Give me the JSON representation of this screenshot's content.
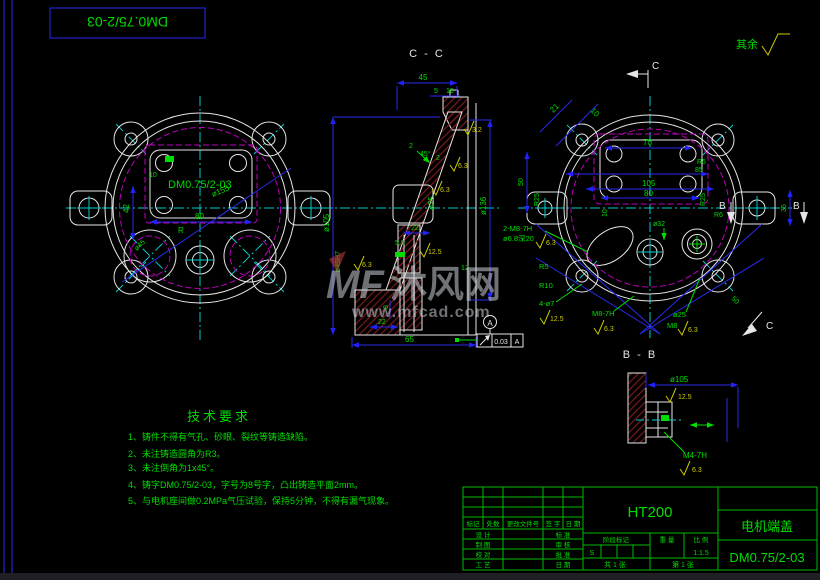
{
  "frame": {
    "flipped_title": "DM0.75/2-03"
  },
  "rest_note": {
    "label": "其余"
  },
  "left_view": {
    "part_label": "DM0.75/2-03",
    "dia_155": "ø155",
    "width_80": "80",
    "height_42": "42",
    "radius_r": "R",
    "dia_45": "ø45",
    "dim_10": "10"
  },
  "section_cc": {
    "title": "C - C",
    "depth_45": "45",
    "step_5": "5",
    "step_10": "10",
    "chamfer_left": "2",
    "chamfer_angle": "45°",
    "chamfer_right": "2",
    "dia_105": "ø105",
    "dia_136": "ø136",
    "dia_25": "ø25",
    "bore": "ø45H7",
    "len_22_upper": "22",
    "len_5_5": "5.5",
    "len_8": "8",
    "len_22_lower": "22",
    "len_65": "65",
    "len_12": "12",
    "finish_3_2": "3.2",
    "finish_6_3_a": "6.3",
    "finish_6_3_b": "6.3",
    "finish_6_3_c": "6.3",
    "finish_12_5": "12.5",
    "datum_label": "A",
    "tolerance_value": "0.03",
    "tolerance_datum": "A"
  },
  "right_view": {
    "cut_label_c_top": "C",
    "cut_label_c_bottom": "C",
    "cut_label_b_left": "B",
    "cut_label_b_right": "B",
    "dim_21": "21",
    "dim_10_diag": "10",
    "dim_70": "70",
    "dim_r5_top": "R5",
    "dim_85": "85",
    "dim_105": "105",
    "dim_80": "80",
    "dim_r25_left": "R25",
    "dim_r25_right": "R25",
    "dim_50_left": "50",
    "dim_35": "35",
    "dim_10_small": "10",
    "dia_32": "ø32",
    "dim_r6": "R6",
    "dim_50_diag": "50",
    "thread_note": "2-M8-7H",
    "drill_note": "ø6.8深20",
    "finish_6_3_a": "6.3",
    "r5_note": "R5",
    "r10_note": "R10",
    "holes_note": "4-ø7",
    "finish_12_5": "12.5",
    "m8_note": "M8-7H",
    "finish_6_3_b": "6.3",
    "dia_25": "ø25",
    "m8_small": "M8",
    "finish_6_3_c": "6.3"
  },
  "section_bb": {
    "title": "B - B",
    "dia_105": "ø105",
    "finish_12_5": "12.5",
    "thread_m4": "M4-7H",
    "finish_6_3": "6.3"
  },
  "tech_req": {
    "title": "技术要求",
    "items": [
      "1、铸件不得有气孔、砂眼、裂纹等铸造缺陷。",
      "2、未注铸造圆角为R3。",
      "3、未注倒角为1x45°。",
      "4、铸字DM0.75/2-03，字号为8号字，凸出铸造平面2mm。",
      "5、与电机座间做0.2MPa气压试验，保持5分钟，不得有漏气现象。"
    ]
  },
  "title_block": {
    "material": "HT200",
    "part_name": "电机端盖",
    "drawing_no": "DM0.75/2-03",
    "rev_headers": [
      "标记",
      "处数",
      "更改文件号",
      "签 字",
      "日 期"
    ],
    "roles_left": [
      "设 计",
      "制 图",
      "校 对",
      "工 艺"
    ],
    "roles_right": [
      "标 准",
      "审 核",
      "批 准",
      "日 期"
    ],
    "stage_header": "阶段标记",
    "weight_header": "重 量",
    "scale_header": "比 例",
    "stage_value": "S",
    "scale_value": "1:1.5",
    "sheet_total": "共 1 张",
    "sheet_index": "第 1 张"
  },
  "watermark": {
    "logo": "MF",
    "site_name": "沐风网",
    "site_url": "www.mfcad.com"
  },
  "colors": {
    "background": "#000000",
    "geometry": "#e6e6e6",
    "dimension_blue": "#2222ff",
    "annotation_green": "#00dd00",
    "centerline_cyan": "#00cccc",
    "hidden_magenta": "#bb00bb",
    "finish_yellow": "#cccc00",
    "hatch_red": "#7a1a1a"
  }
}
